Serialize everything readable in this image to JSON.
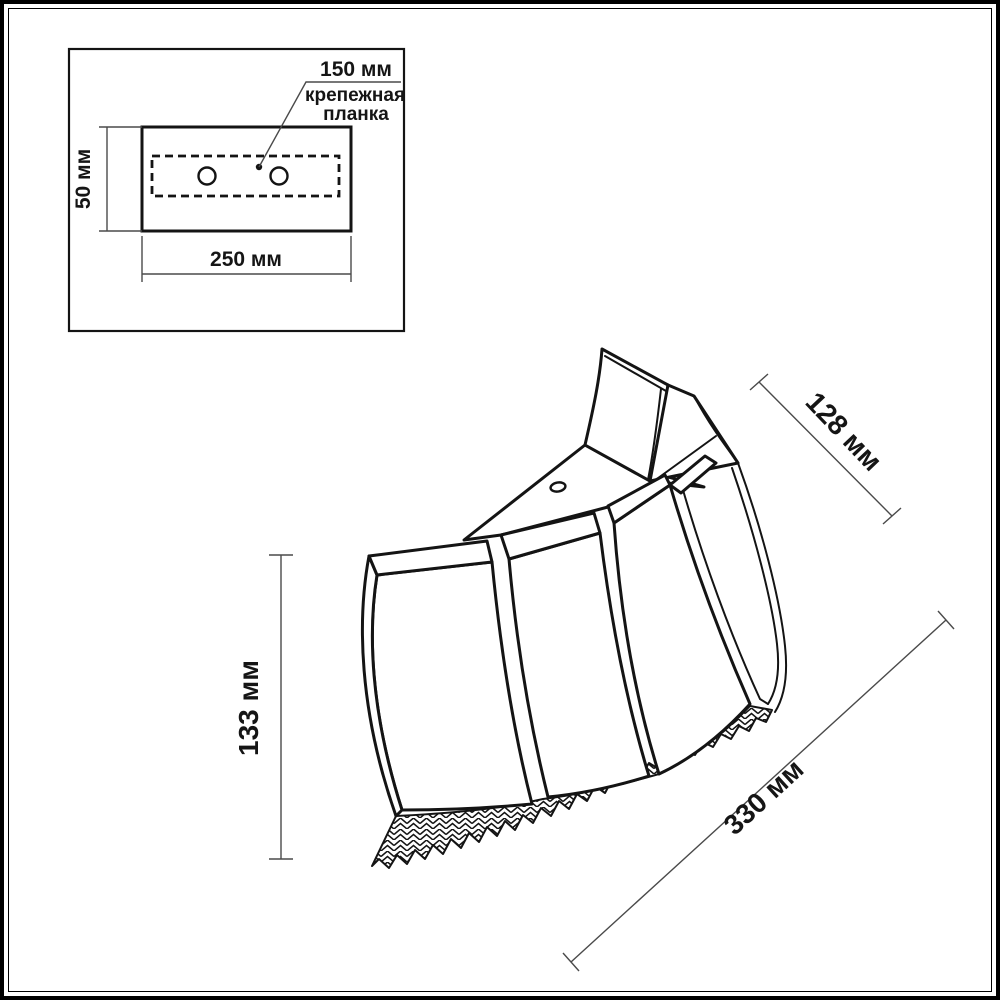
{
  "page": {
    "background": "#ffffff",
    "line_color": "#141414",
    "dim_line_color": "#4a4a4a"
  },
  "inset_diagram": {
    "name": "mounting-plate-top-view",
    "holes_spacing_label": "150 мм",
    "plate_label_line1": "крепежная",
    "plate_label_line2": "планка",
    "height_label": "50 мм",
    "width_label": "250 мм",
    "hole_count": 2
  },
  "main_drawing": {
    "name": "sconce-shade-3d-view",
    "top_width_label": "128 мм",
    "height_label": "133 мм",
    "bottom_width_label": "330 мм"
  }
}
